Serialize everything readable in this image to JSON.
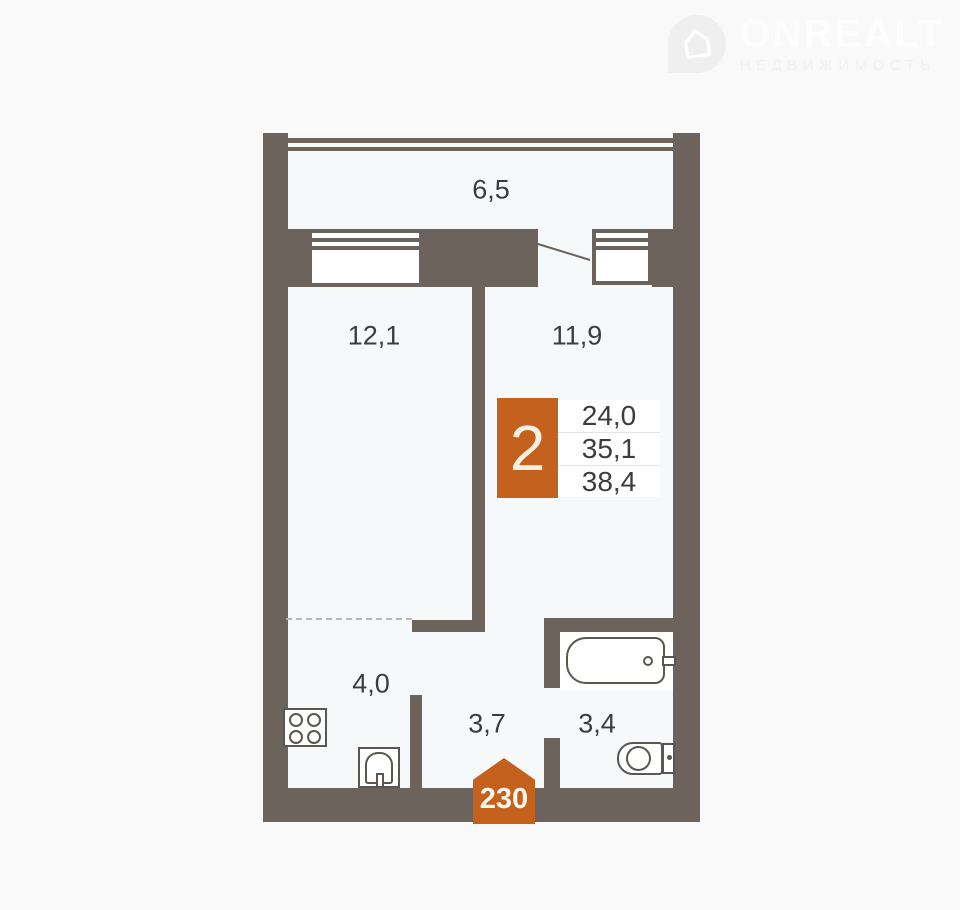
{
  "logo": {
    "brand": "ONREALT",
    "tagline": "НЕДВИЖИМОСТЬ",
    "icon": "house-pin-icon"
  },
  "floor_plan": {
    "areas": {
      "balcony": "6,5",
      "room_1": "12,1",
      "room_2": "11,9",
      "kitchen": "4,0",
      "hallway": "3,7",
      "bathroom": "3,4"
    },
    "info_badge": {
      "rooms_count": "2",
      "stats": [
        "24,0",
        "35,1",
        "38,4"
      ]
    },
    "apartment_number": "230",
    "colors": {
      "accent": "#c4611d",
      "wall": "#6b635c",
      "floor": "#f6f9fa"
    }
  }
}
